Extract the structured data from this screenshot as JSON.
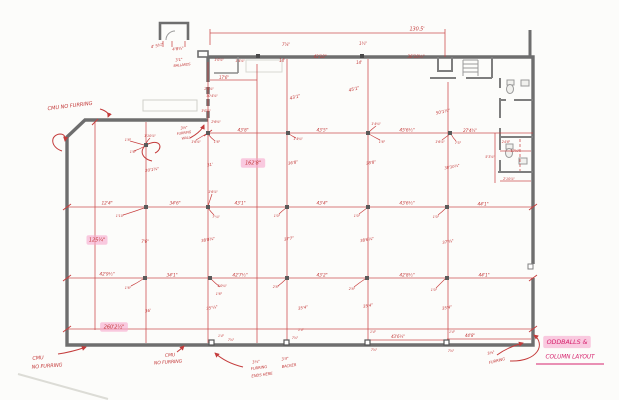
{
  "document": {
    "kind": "hand-drawn floor plan sketch",
    "main_note": "ODDBALLS & COLUMN LAYOUT",
    "overall_dimension": "130.5'"
  },
  "colors": {
    "ink_red": "#c43b3b",
    "note_magenta": "#d6246e",
    "highlighter_pink": "#f7a6cd",
    "wall_gray": "#6e6e6e"
  },
  "annotations": [
    {
      "t": "4' 5¾\"",
      "x": 157,
      "y": 46,
      "s": 4,
      "r": -12
    },
    {
      "t": "4'8¾\"",
      "x": 178,
      "y": 49,
      "s": 4,
      "r": -6
    },
    {
      "t": "3'1\"",
      "x": 179,
      "y": 60,
      "s": 3.8,
      "r": -6
    },
    {
      "t": "BALLARDS",
      "x": 182,
      "y": 65,
      "s": 3.4,
      "r": -6
    },
    {
      "t": "1'0⅝\"",
      "x": 219,
      "y": 60,
      "s": 3.4
    },
    {
      "t": "1'4⅝\"",
      "x": 240,
      "y": 61,
      "s": 3.4
    },
    {
      "t": "17'6\"",
      "x": 224,
      "y": 78,
      "s": 4
    },
    {
      "t": "2'0⅝\"",
      "x": 209,
      "y": 89,
      "s": 3.4
    },
    {
      "t": "30'4⅝\"",
      "x": 212,
      "y": 96,
      "s": 3.4
    },
    {
      "t": "3'0⅝\"",
      "x": 206,
      "y": 111,
      "s": 3.4
    },
    {
      "t": "2'6⅜\"",
      "x": 216,
      "y": 122,
      "s": 3.4
    },
    {
      "t": "3⅝\"",
      "x": 184,
      "y": 128,
      "s": 3.6,
      "r": -8
    },
    {
      "t": "FURRING",
      "x": 184,
      "y": 133,
      "s": 3.4,
      "r": -8
    },
    {
      "t": "WALL",
      "x": 186,
      "y": 138,
      "s": 3.4,
      "r": -8
    },
    {
      "t": "1'6⅝\"",
      "x": 196,
      "y": 142,
      "s": 3.4
    },
    {
      "t": "1'6\"",
      "x": 217,
      "y": 142,
      "s": 3.4
    },
    {
      "t": "7⅞\"",
      "x": 286,
      "y": 45,
      "s": 4
    },
    {
      "t": "14'",
      "x": 282,
      "y": 61,
      "s": 4
    },
    {
      "t": "1¾\"",
      "x": 363,
      "y": 44,
      "s": 4
    },
    {
      "t": "14'",
      "x": 359,
      "y": 63,
      "s": 4
    },
    {
      "t": "43'10\"",
      "x": 320,
      "y": 57,
      "s": 4.2
    },
    {
      "t": "36'10½\"",
      "x": 416,
      "y": 57,
      "s": 4.2
    },
    {
      "t": "130.5'",
      "x": 417,
      "y": 29,
      "s": 5
    },
    {
      "t": "CMU NO FURRING",
      "x": 70,
      "y": 106,
      "s": 5.2,
      "r": -7
    },
    {
      "t": "43'1\"",
      "x": 295,
      "y": 97,
      "s": 4.4,
      "r": -15
    },
    {
      "t": "45'1\"",
      "x": 354,
      "y": 89,
      "s": 4.4,
      "r": -15
    },
    {
      "t": "50'1¼\"",
      "x": 443,
      "y": 112,
      "s": 4.2,
      "r": -12
    },
    {
      "t": "1'4¾\"",
      "x": 376,
      "y": 124,
      "s": 3.4
    },
    {
      "t": "43'8\"",
      "x": 243,
      "y": 130,
      "s": 4.4
    },
    {
      "t": "43'5\"",
      "x": 322,
      "y": 130,
      "s": 4.4
    },
    {
      "t": "45'6½\"",
      "x": 407,
      "y": 130,
      "s": 4.4
    },
    {
      "t": "27'4¾\"",
      "x": 470,
      "y": 131,
      "s": 4
    },
    {
      "t": "1'4¾\"",
      "x": 298,
      "y": 139,
      "s": 3.4
    },
    {
      "t": "1'6\"",
      "x": 382,
      "y": 142,
      "s": 3.4
    },
    {
      "t": "1'6⅞\"",
      "x": 440,
      "y": 142,
      "s": 3.4
    },
    {
      "t": "7'5\"",
      "x": 458,
      "y": 143,
      "s": 3.4
    },
    {
      "t": "1'10⅞\"",
      "x": 150,
      "y": 136,
      "s": 3.4
    },
    {
      "t": "1'8\"",
      "x": 128,
      "y": 140,
      "s": 3.4
    },
    {
      "t": "1'6\"",
      "x": 133,
      "y": 152,
      "s": 3.4
    },
    {
      "t": "162'8\"",
      "x": 253,
      "y": 163,
      "s": 5,
      "hl": 1
    },
    {
      "t": "31'",
      "x": 210,
      "y": 165,
      "s": 4,
      "r": -12
    },
    {
      "t": "36'8\"",
      "x": 293,
      "y": 163,
      "s": 4,
      "r": -10
    },
    {
      "t": "38'8\"",
      "x": 371,
      "y": 163,
      "s": 4,
      "r": -10
    },
    {
      "t": "38'10¼\"",
      "x": 452,
      "y": 167,
      "s": 3.8,
      "r": -10
    },
    {
      "t": "20'1¾\"",
      "x": 152,
      "y": 170,
      "s": 4,
      "r": -8
    },
    {
      "t": "24'8\"",
      "x": 506,
      "y": 142,
      "s": 3.4
    },
    {
      "t": "17⅞\"",
      "x": 515,
      "y": 151,
      "s": 3.4
    },
    {
      "t": "5'3⅝\"",
      "x": 490,
      "y": 157,
      "s": 3.4
    },
    {
      "t": "2'10⅞\"",
      "x": 509,
      "y": 179,
      "s": 3.4
    },
    {
      "t": "12'4\"",
      "x": 107,
      "y": 203,
      "s": 4.4
    },
    {
      "t": "34'6\"",
      "x": 175,
      "y": 203,
      "s": 4.4
    },
    {
      "t": "43'1\"",
      "x": 240,
      "y": 203,
      "s": 4.4
    },
    {
      "t": "43'4\"",
      "x": 322,
      "y": 203,
      "s": 4.4
    },
    {
      "t": "43'6½\"",
      "x": 407,
      "y": 203,
      "s": 4.4
    },
    {
      "t": "44'1\"",
      "x": 483,
      "y": 204,
      "s": 4.4
    },
    {
      "t": "1'6⅞\"",
      "x": 213,
      "y": 192,
      "s": 3.4
    },
    {
      "t": "1'10\"",
      "x": 120,
      "y": 216,
      "s": 3.4
    },
    {
      "t": "7'¼\"",
      "x": 216,
      "y": 217,
      "s": 3.4
    },
    {
      "t": "1'0\"",
      "x": 277,
      "y": 216,
      "s": 3.4
    },
    {
      "t": "1'0\"",
      "x": 357,
      "y": 216,
      "s": 3.4
    },
    {
      "t": "1'0\"",
      "x": 436,
      "y": 217,
      "s": 3.4
    },
    {
      "t": "125¼\"",
      "x": 97,
      "y": 240,
      "s": 5,
      "hl": 1
    },
    {
      "t": "38'8¾\"",
      "x": 208,
      "y": 240,
      "s": 4,
      "r": -10
    },
    {
      "t": "37'7\"",
      "x": 289,
      "y": 239,
      "s": 4,
      "r": -10
    },
    {
      "t": "38'6¼\"",
      "x": 367,
      "y": 240,
      "s": 4,
      "r": -10
    },
    {
      "t": "37'¾\"",
      "x": 448,
      "y": 242,
      "s": 4,
      "r": -10
    },
    {
      "t": "7'6\"",
      "x": 145,
      "y": 242,
      "s": 4
    },
    {
      "t": "42'9½\"",
      "x": 107,
      "y": 274,
      "s": 4.4
    },
    {
      "t": "34'1\"",
      "x": 172,
      "y": 275,
      "s": 4.4
    },
    {
      "t": "42'7½\"",
      "x": 240,
      "y": 275,
      "s": 4.4
    },
    {
      "t": "43'2\"",
      "x": 322,
      "y": 275,
      "s": 4.4
    },
    {
      "t": "42'8½\"",
      "x": 407,
      "y": 275,
      "s": 4.4
    },
    {
      "t": "44'1\"",
      "x": 484,
      "y": 275,
      "s": 4.4
    },
    {
      "t": "1'6\"",
      "x": 128,
      "y": 288,
      "s": 3.4
    },
    {
      "t": "1'0¾\"",
      "x": 222,
      "y": 286,
      "s": 3.4
    },
    {
      "t": "1'6\"",
      "x": 219,
      "y": 294,
      "s": 3.4
    },
    {
      "t": "2'8\"",
      "x": 276,
      "y": 287,
      "s": 3.4
    },
    {
      "t": "2'8\"",
      "x": 352,
      "y": 289,
      "s": 3.4
    },
    {
      "t": "1'0\"",
      "x": 434,
      "y": 290,
      "s": 3.4
    },
    {
      "t": "36'",
      "x": 148,
      "y": 311,
      "s": 4,
      "r": -10
    },
    {
      "t": "35'¼\"",
      "x": 212,
      "y": 308,
      "s": 4,
      "r": -10
    },
    {
      "t": "35'4\"",
      "x": 303,
      "y": 308,
      "s": 4,
      "r": -10
    },
    {
      "t": "35'4\"",
      "x": 368,
      "y": 306,
      "s": 4,
      "r": -10
    },
    {
      "t": "35'4\"",
      "x": 447,
      "y": 308,
      "s": 4,
      "r": -10
    },
    {
      "t": "260'2½\"",
      "x": 114,
      "y": 327,
      "s": 5,
      "hl": 1
    },
    {
      "t": "43'6¼\"",
      "x": 398,
      "y": 337,
      "s": 4
    },
    {
      "t": "44'8\"",
      "x": 470,
      "y": 336,
      "s": 4
    },
    {
      "t": "1'4\"",
      "x": 221,
      "y": 336,
      "s": 3.2
    },
    {
      "t": "7⅞\"",
      "x": 231,
      "y": 340,
      "s": 3.2
    },
    {
      "t": "7⅞\"",
      "x": 295,
      "y": 338,
      "s": 3.2
    },
    {
      "t": "1'4\"",
      "x": 301,
      "y": 330,
      "s": 3.2
    },
    {
      "t": "1'4\"",
      "x": 373,
      "y": 332,
      "s": 3.2
    },
    {
      "t": "7⅞\"",
      "x": 374,
      "y": 350,
      "s": 3.2
    },
    {
      "t": "1'4\"",
      "x": 452,
      "y": 332,
      "s": 3.2
    },
    {
      "t": "7⅞\"",
      "x": 451,
      "y": 351,
      "s": 3.2
    },
    {
      "t": "CMU",
      "x": 38,
      "y": 358,
      "s": 5,
      "r": -4
    },
    {
      "t": "NO FURRING",
      "x": 47,
      "y": 366,
      "s": 5,
      "r": -4
    },
    {
      "t": "CMU",
      "x": 170,
      "y": 355,
      "s": 4.6,
      "r": -4
    },
    {
      "t": "NO FURRING",
      "x": 168,
      "y": 362,
      "s": 4.6,
      "r": -4
    },
    {
      "t": "3⅛\"",
      "x": 256,
      "y": 362,
      "s": 3.8,
      "r": -8
    },
    {
      "t": "FURRING",
      "x": 259,
      "y": 368,
      "s": 3.8,
      "r": -8
    },
    {
      "t": "ENDS HERE",
      "x": 262,
      "y": 375,
      "s": 3.8,
      "r": -8
    },
    {
      "t": "3'4\"",
      "x": 285,
      "y": 359,
      "s": 3.8,
      "r": -8
    },
    {
      "t": "BACKER",
      "x": 289,
      "y": 366,
      "s": 3.8,
      "r": -8
    },
    {
      "t": "3⅛\"",
      "x": 491,
      "y": 353,
      "s": 3.8,
      "r": -14
    },
    {
      "t": "FURRING",
      "x": 497,
      "y": 361,
      "s": 3.8,
      "r": -14
    },
    {
      "t": "ODDBALLS &",
      "x": 567,
      "y": 342,
      "s": 6.4,
      "hl": 1,
      "c": "note"
    },
    {
      "t": "COLUMN LAYOUT",
      "x": 570,
      "y": 357,
      "s": 5.8,
      "c": "note"
    }
  ]
}
